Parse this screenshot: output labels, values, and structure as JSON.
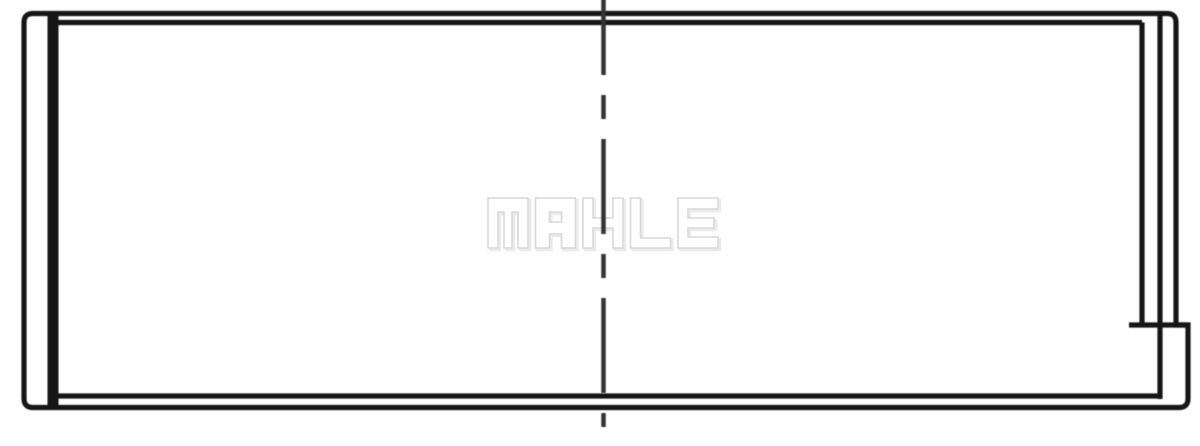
{
  "image": {
    "width": 1200,
    "height": 446,
    "background_color": "#ffffff"
  },
  "drawing": {
    "stroke_color": "#161616",
    "stroke_width": 5.2,
    "outer_contour_path": "M 24 398.5 L 24 22.5 Q 24 13.5 33 13.5 L 1167 13.5 Q 1176 13.5 1176 22.5 L 1176 325 L 1188 325 L 1188 398.5 Q 1188 407.5 1179 407.5 L 33 407.5 Q 24 407.5 24 398.5 Z",
    "lines": [
      {
        "name": "left-wall-edge-line",
        "x1": 53,
        "y1": 11,
        "x2": 53,
        "y2": 410,
        "width": 11
      },
      {
        "name": "inner-top-edge-line",
        "x1": 53,
        "y1": 22.5,
        "x2": 1142,
        "y2": 22.5,
        "width": 5.2
      },
      {
        "name": "inner-bottom-edge-line",
        "x1": 53,
        "y1": 396,
        "x2": 1160,
        "y2": 396,
        "width": 5.2
      },
      {
        "name": "right-inner-edge-line",
        "x1": 1142,
        "y1": 22.5,
        "x2": 1142,
        "y2": 327,
        "width": 5.2
      },
      {
        "name": "right-wall-edge-line",
        "x1": 1160,
        "y1": 13.5,
        "x2": 1160,
        "y2": 399,
        "width": 5.2
      },
      {
        "name": "right-step-line",
        "x1": 1129,
        "y1": 325,
        "x2": 1188,
        "y2": 325,
        "width": 5.2
      }
    ],
    "centerline": {
      "x": 603.5,
      "y1": -20,
      "y2": 427,
      "width": 4.5,
      "color": "#333333",
      "dash_pattern": "95 20 24 20"
    },
    "watermark": {
      "text": "MAHLE",
      "fill_color": "#ffffff",
      "outline_color": "#d8d8d8",
      "shadow_color": "#ebebeb",
      "x": 488,
      "y": 198,
      "letter_height": 50,
      "letter_width": 40,
      "letter_advance": 47.5
    }
  }
}
